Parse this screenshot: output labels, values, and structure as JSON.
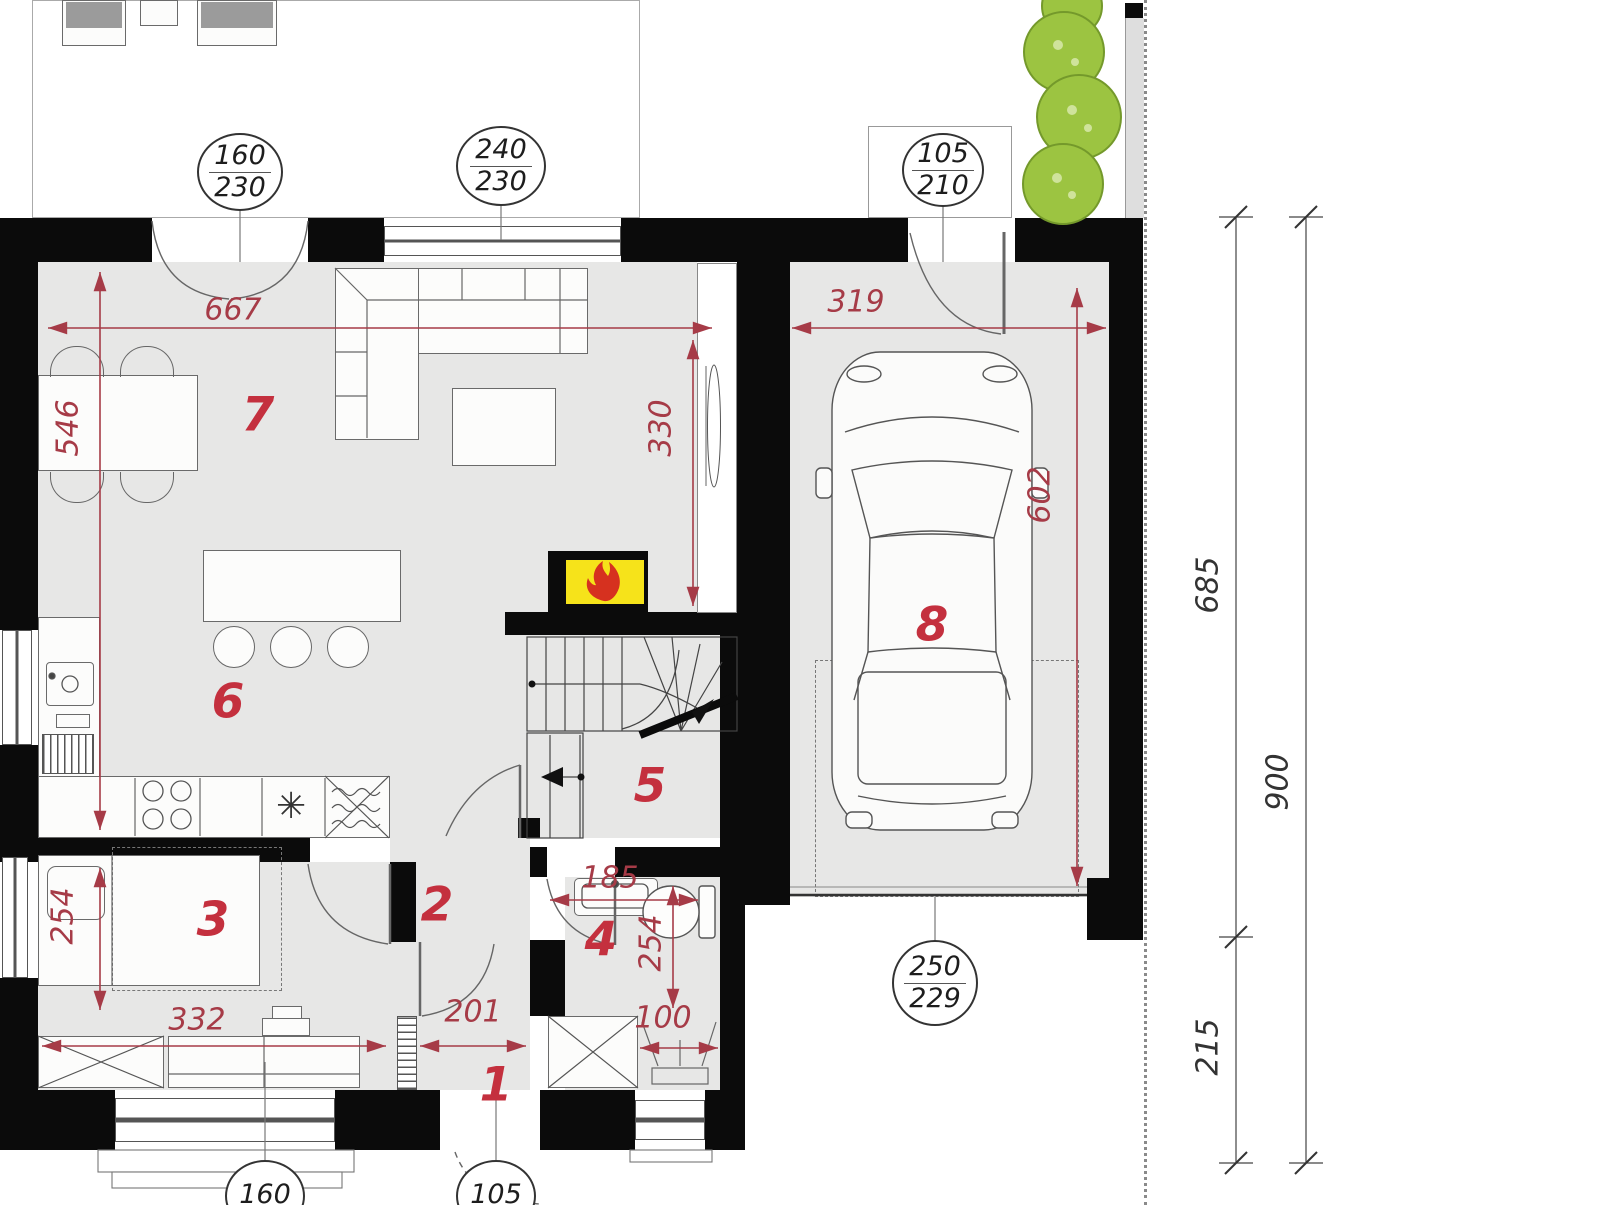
{
  "title": "house-ground-floor-plan",
  "colors": {
    "wall": "#0b0b0b",
    "floor": "#e7e7e6",
    "dim_red": "#a63b47",
    "room_red": "#c4303e",
    "bush_green": "#9cc441",
    "fire_yellow": "#f6e31a",
    "flame_red": "#d6311f",
    "line_gray": "#666666"
  },
  "room_numbers": {
    "entry": "1",
    "hall": "2",
    "bedroom": "3",
    "bathroom": "4",
    "stair_hall": "5",
    "kitchen": "6",
    "living_room": "7",
    "garage": "8"
  },
  "interior_dimensions": {
    "living_width": "667",
    "living_depth": "546",
    "tv_wall_length": "330",
    "garage_width": "319",
    "garage_depth": "602",
    "bedroom_depth": "254",
    "bedroom_width": "332",
    "hall_width": "201",
    "bath_width": "185",
    "bath_depth": "254",
    "shower_width": "100"
  },
  "exterior_dimensions": {
    "upper_segment": "685",
    "lower_segment": "215",
    "total": "900"
  },
  "opening_tags": {
    "terrace_door": {
      "width": "160",
      "height": "230"
    },
    "living_window": {
      "width": "240",
      "height": "230"
    },
    "garage_side_door": {
      "width": "105",
      "height": "210"
    },
    "garage_gate": {
      "width": "250",
      "height": "229"
    },
    "bedroom_window": {
      "width": "160"
    },
    "entry_door": {
      "width": "105"
    }
  },
  "icons": {
    "sink_star": "✳"
  }
}
